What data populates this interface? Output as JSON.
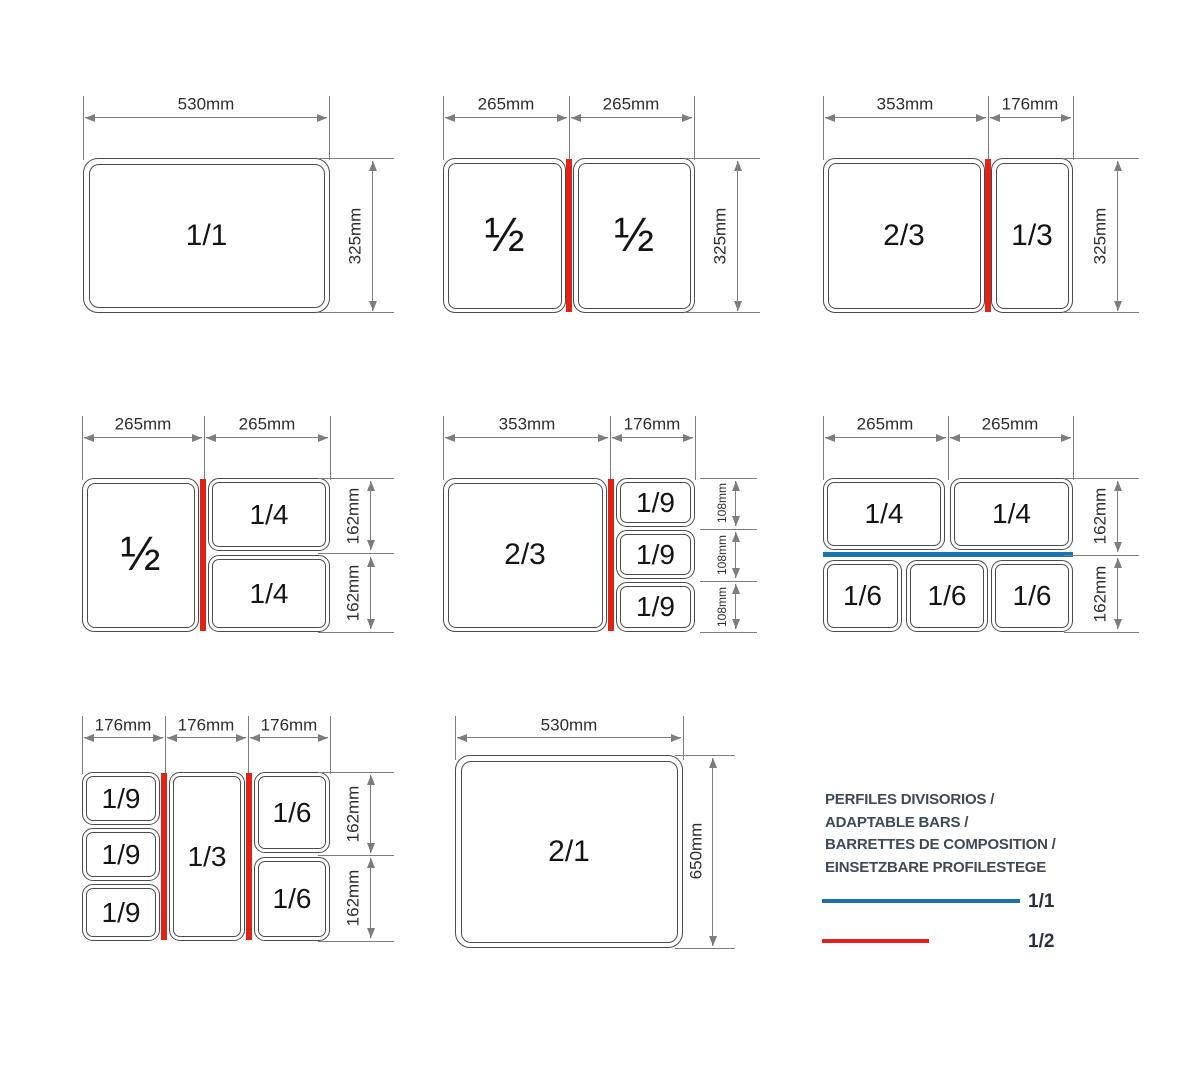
{
  "colors": {
    "red_bar": "#e02317",
    "blue_bar": "#1b74ad",
    "line_gray": "#7d7d7d"
  },
  "panels": [
    {
      "top_dims": [
        "530mm"
      ],
      "side_dims": [
        "325mm"
      ],
      "pans": [
        "1/1"
      ],
      "divider": "none"
    },
    {
      "top_dims": [
        "265mm",
        "265mm"
      ],
      "side_dims": [
        "325mm"
      ],
      "pans": [
        "½",
        "½"
      ],
      "divider": "red"
    },
    {
      "top_dims": [
        "353mm",
        "176mm"
      ],
      "side_dims": [
        "325mm"
      ],
      "pans": [
        "2/3",
        "1/3"
      ],
      "divider": "red"
    },
    {
      "top_dims": [
        "265mm",
        "265mm"
      ],
      "side_dims": [
        "162mm",
        "162mm"
      ],
      "pans": [
        "½",
        "1/4",
        "1/4"
      ],
      "divider": "red"
    },
    {
      "top_dims": [
        "353mm",
        "176mm"
      ],
      "side_dims": [
        "108mm",
        "108mm",
        "108mm"
      ],
      "pans": [
        "2/3",
        "1/9",
        "1/9",
        "1/9"
      ],
      "divider": "red"
    },
    {
      "top_dims": [
        "265mm",
        "265mm"
      ],
      "side_dims": [
        "162mm",
        "162mm"
      ],
      "pans": [
        "1/4",
        "1/4",
        "1/6",
        "1/6",
        "1/6"
      ],
      "divider": "blue"
    },
    {
      "top_dims": [
        "176mm",
        "176mm",
        "176mm"
      ],
      "side_dims": [
        "162mm",
        "162mm"
      ],
      "pans": [
        "1/9",
        "1/9",
        "1/9",
        "1/3",
        "1/6",
        "1/6"
      ],
      "divider": "red"
    },
    {
      "top_dims": [
        "530mm"
      ],
      "side_dims": [
        "650mm"
      ],
      "pans": [
        "2/1"
      ],
      "divider": "none"
    }
  ],
  "legend": {
    "title_lines": [
      "PERFILES DIVISORIOS /",
      "ADAPTABLE BARS /",
      "BARRETTES DE COMPOSITION /",
      "EINSETZBARE PROFILESTEGE"
    ],
    "items": [
      {
        "label": "1/1",
        "color": "#1b70aa"
      },
      {
        "label": "1/2",
        "color": "#e32119"
      }
    ]
  }
}
